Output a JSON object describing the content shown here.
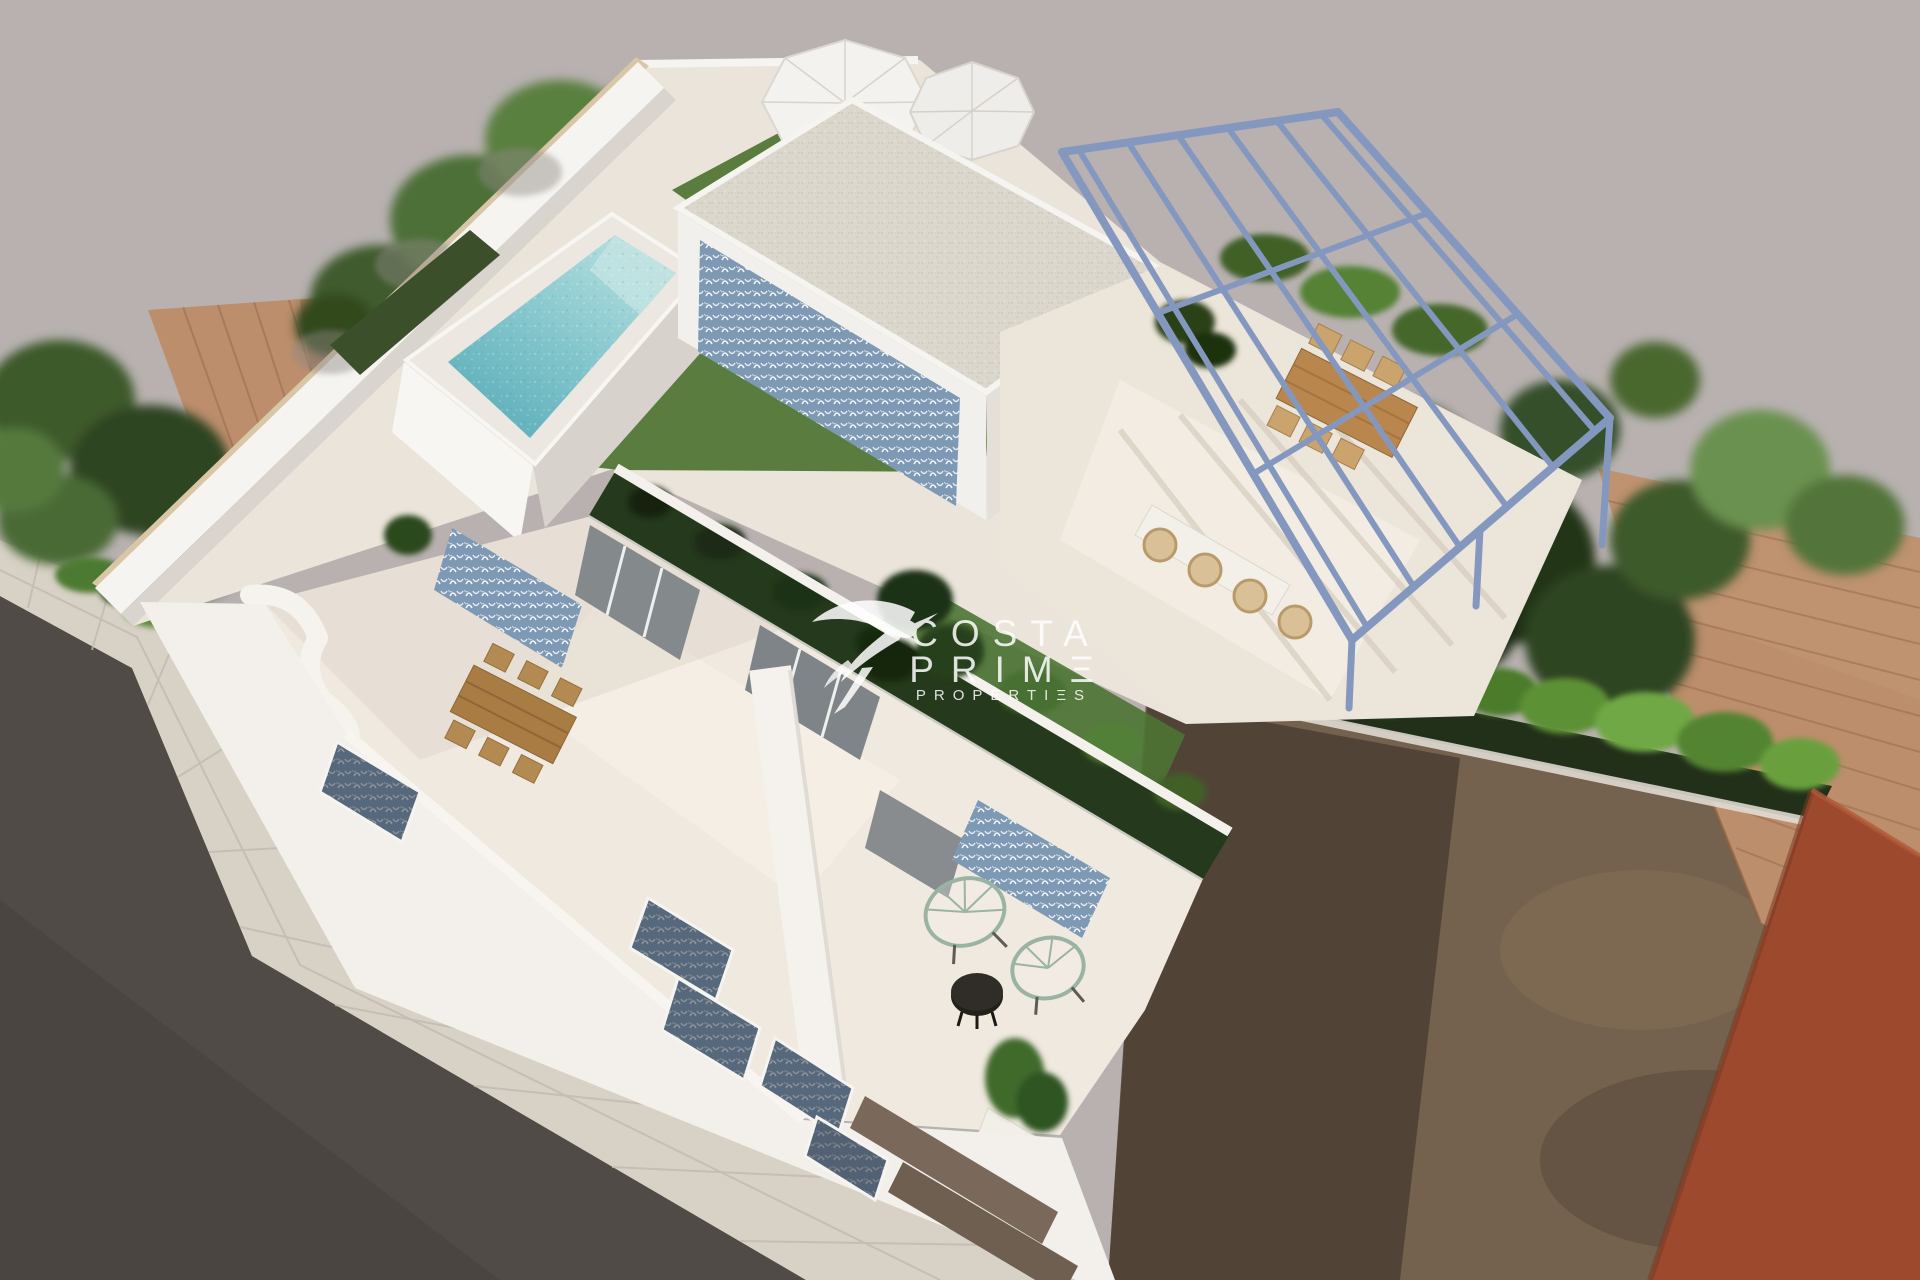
{
  "watermark": {
    "line1": "COSTA",
    "line2": "PRIMΞ",
    "line3": "PROPERTIΞS"
  },
  "palette": {
    "bg": "#b8b1b0",
    "road": "#514b47",
    "road_shadow": "#45403c",
    "sidewalk": "#d8d1c6",
    "sidewalk_joint": "#c2bab0",
    "dirt": "#74614e",
    "dirt_shadow": "#3a3128",
    "orange_building": "#9c492e",
    "roof_tile": "#bc8e6c",
    "roof_tile_dark": "#a3765a",
    "hedge_dark": "#22301a",
    "hedge_bright": "#5d9135",
    "tree_dark": "#2a3e20",
    "tree_mid": "#44622f",
    "tree_light": "#6a9150",
    "wall_white": "#f6f4f0",
    "wall_shadow": "#d9d4ce",
    "coping_beige": "#d8c6a6",
    "deck_floor": "#eae4da",
    "terrace_floor": "#f0e9e0",
    "facade_white": "#f3f0ec",
    "grass": "#5a7c3e",
    "grass_dark": "#253a1c",
    "pool_water_light": "#aedbdc",
    "pool_water_deep": "#66b5bf",
    "pool_coping": "#ece8e1",
    "gravel": "#dcd7cd",
    "pergola_blue": "#8498bf",
    "pattern_blue": "#7e99b4",
    "wood": "#b9874e",
    "wood_dark": "#8d6636",
    "wicker": "#d9c096",
    "black_table": "#232019",
    "chair_wire": "#9ab3a3",
    "watermark": "#ffffff"
  }
}
